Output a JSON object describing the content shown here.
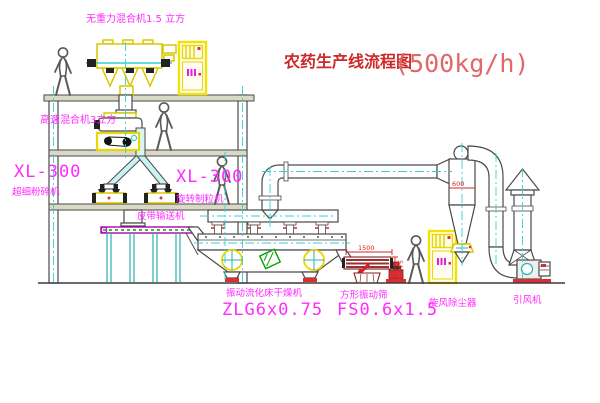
{
  "title": {
    "main": "农药生产线流程图",
    "capacity": "(500kg/h)"
  },
  "equipment_labels": {
    "gravity_mixer": "无重力混合机1.5 立方",
    "high_speed_mixer": "高速混合机3立方",
    "pulverizer_model": "XL-300",
    "pulverizer": "超细粉碎机",
    "granulator_model": "XL-300",
    "granulator": "旋转制粒机",
    "belt_conveyor": "皮带输送机",
    "dryer": "振动流化床干燥机",
    "dryer_model": "ZLG6x0.75",
    "screen": "方形振动筛",
    "screen_model": "FS0.6x1.5",
    "cyclone": "旋风除尘器",
    "fan": "引风机"
  },
  "dimensions": {
    "screen_length": "1500",
    "screen_height": "545",
    "cyclone_diameter": "600"
  },
  "colors": {
    "label_magenta": "#ff2bff",
    "title_red": "#cc2a2a",
    "capacity_red": "#e06868",
    "machine_yellow": "#f2e400",
    "centerline_cyan": "#35d0d0",
    "dimension_red": "#d82020",
    "conveyor_magenta": "#b000b0",
    "conveyor_green": "#00a000",
    "screen_maroon": "#993333",
    "background": "#ffffff"
  }
}
